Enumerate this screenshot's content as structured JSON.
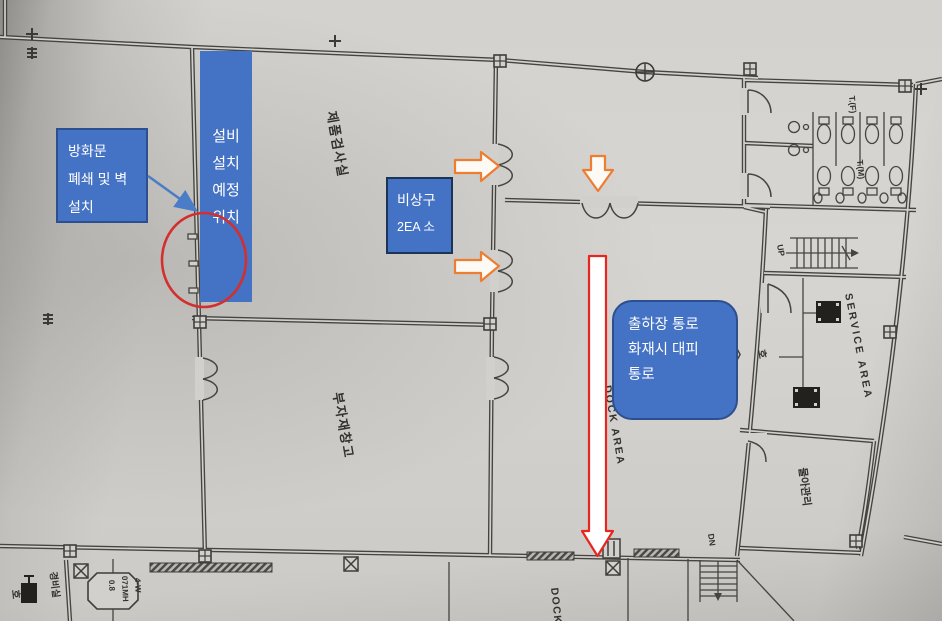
{
  "colors": {
    "box_fill": "#4472c4",
    "box_border": "#2c508f",
    "arrow_orange": "#ed7d31",
    "arrow_red": "#e8251f",
    "circle_red": "#d42f2f",
    "callout_blue": "#4a7cc7"
  },
  "callouts": {
    "fire_door": {
      "line1": "방화문",
      "line2": "폐쇄 및 벽",
      "line3": "설치"
    },
    "equipment": {
      "line1": "설비",
      "line2": "설치",
      "line3": "예정",
      "line4": "위치"
    },
    "emergency_exit": {
      "line1": "비상구",
      "line2": "2EA 소"
    },
    "dock_passage": {
      "line1": "출하장 통로",
      "line2": "화재시 대피",
      "line3": "통로"
    }
  },
  "plan": {
    "rooms": {
      "inspection_room": "제품검사실",
      "materials_warehouse": "부자재창고",
      "guard_room": "경비실",
      "management_room": "물아관리",
      "toilet_female": "T.(F)",
      "toilet_male": "T.(M)"
    },
    "areas": {
      "service_area": "SERVICE AREA",
      "dock_area": "DOCK AREA",
      "dock": "DOCK"
    },
    "symbols": {
      "up": "UP",
      "dn": "DN",
      "marker_4w": "4-W",
      "manhole_line1": "4-W",
      "manhole_line2": "071MH",
      "manhole_line3": "0.8",
      "hydrant": "호"
    }
  }
}
